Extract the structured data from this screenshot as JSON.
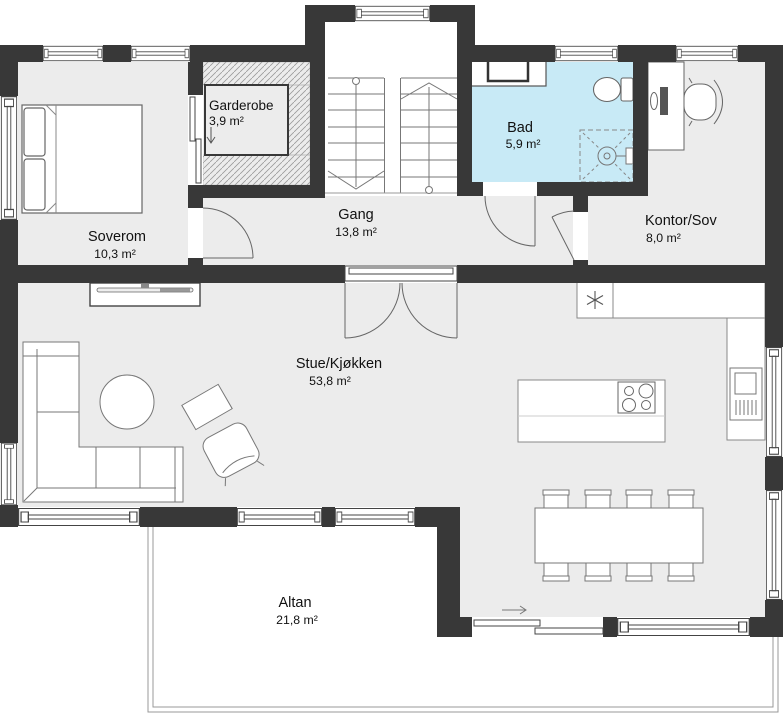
{
  "plan": {
    "rooms": {
      "soverom": {
        "name": "Soverom",
        "area": "10,3 m²"
      },
      "garderobe": {
        "name": "Garderobe",
        "area": "3,9 m²"
      },
      "gang": {
        "name": "Gang",
        "area": "13,8 m²"
      },
      "bad": {
        "name": "Bad",
        "area": "5,9 m²"
      },
      "kontor": {
        "name": "Kontor/Sov",
        "area": "8,0 m²"
      },
      "stue": {
        "name": "Stue/Kjøkken",
        "area": "53,8 m²"
      },
      "altan": {
        "name": "Altan",
        "area": "21,8 m²"
      }
    },
    "colors": {
      "wall": "#383838",
      "floor": "#ececec",
      "bathroom_floor": "#c8eaf6",
      "outline": "#999999",
      "background": "#ffffff"
    }
  }
}
